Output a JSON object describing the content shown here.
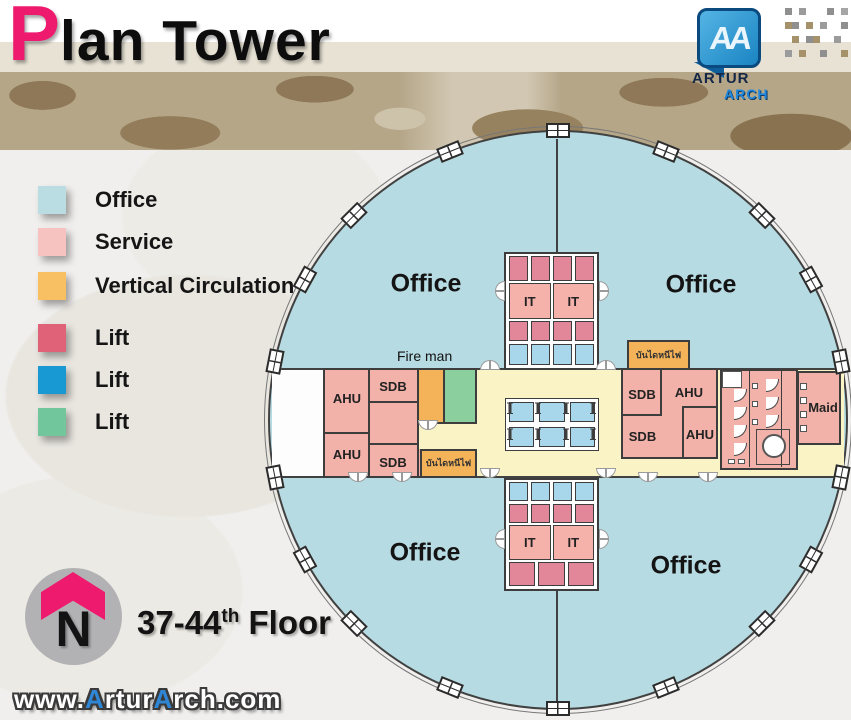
{
  "header": {
    "title_accent": "P",
    "title_rest": "lan Tower",
    "logo": {
      "mark": "AA",
      "line1": "ARTUR",
      "line2": "ARCH"
    }
  },
  "legend": {
    "items": [
      {
        "label": "Office",
        "color": "#b9dde3"
      },
      {
        "label": "Service",
        "color": "#f6c3c0"
      },
      {
        "label": "Vertical Circulation",
        "color": "#f8bf63"
      },
      {
        "label": "Lift",
        "color": "#e06279"
      },
      {
        "label": "Lift",
        "color": "#1899d4"
      },
      {
        "label": "Lift",
        "color": "#72c69b"
      }
    ]
  },
  "plan": {
    "office_labels": [
      "Office",
      "Office",
      "Office",
      "Office"
    ],
    "fire_man": "Fire man",
    "core": {
      "it": [
        "IT",
        "IT",
        "IT",
        "IT"
      ]
    },
    "left_wing": {
      "ahu_top": "AHU",
      "sdb_top": "SDB",
      "ahu_bottom": "AHU",
      "sdb_bottom": "SDB",
      "stair": "บันไดหนีไฟ"
    },
    "right_wing": {
      "sdb_top": "SDB",
      "ahu_top": "AHU",
      "sdb_bottom": "SDB",
      "ahu_bottom": "AHU",
      "maid": "Maid",
      "stair": "บันไดหนีไฟ"
    }
  },
  "footer": {
    "north_letter": "N",
    "floor_range": "37-44",
    "floor_sup": "th",
    "floor_word": " Floor",
    "watermark": {
      "p1": "www.",
      "a1": "A",
      "p2": "rtur",
      "a2": "A",
      "p3": "rch.com"
    }
  },
  "colors": {
    "office": "#b7dbe2",
    "service": "#f2b1a9",
    "vertical_circulation": "#f5b359",
    "lift_red": "#e2869a",
    "lift_blue": "#a8d7ec",
    "lift_green": "#8ccf9e",
    "corridor": "#faf3c5",
    "wall": "#3d3d3d",
    "accent_pink": "#ee1a6e",
    "watermark_blue": "#2e86d4"
  }
}
